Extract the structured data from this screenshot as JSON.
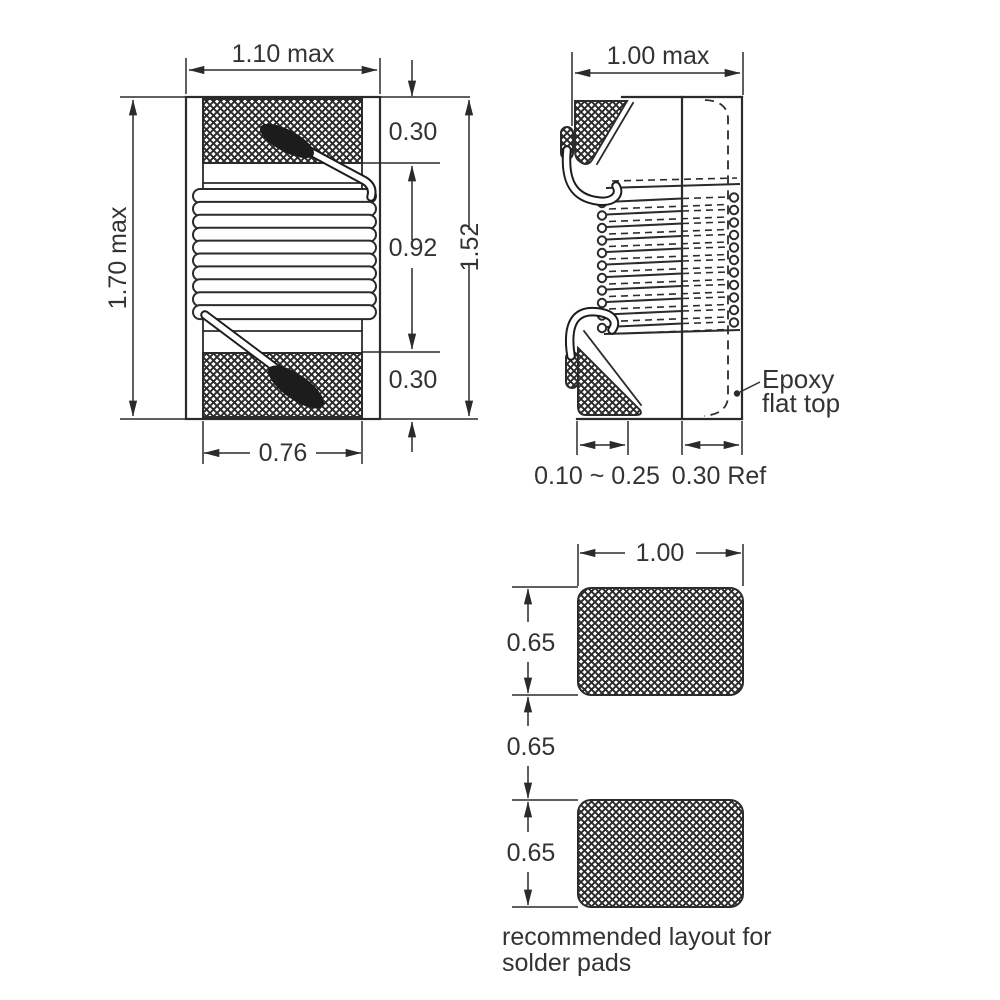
{
  "drawing": {
    "front_view": {
      "overall_width_label": "1.10 max",
      "overall_height_label": "1.70 max",
      "top_electrode_label": "0.30",
      "winding_section_label": "0.92",
      "bottom_electrode_label": "0.30",
      "core_height_label": "1.52",
      "electrode_width_label": "0.76"
    },
    "side_view": {
      "overall_depth_label": "1.00 max",
      "terminal_thickness_label": "0.10 ~ 0.25",
      "epoxy_width_label": "0.30 Ref",
      "epoxy_note_line1": "Epoxy",
      "epoxy_note_line2": "flat top"
    },
    "pad_layout": {
      "pad_width_label": "1.00",
      "top_pad_height_label": "0.65",
      "pad_gap_label": "0.65",
      "bottom_pad_height_label": "0.65",
      "caption_line1": "recommended layout for",
      "caption_line2": "solder pads"
    },
    "colors": {
      "line": "#2b2b2b",
      "text": "#333333",
      "background": "#ffffff"
    }
  }
}
